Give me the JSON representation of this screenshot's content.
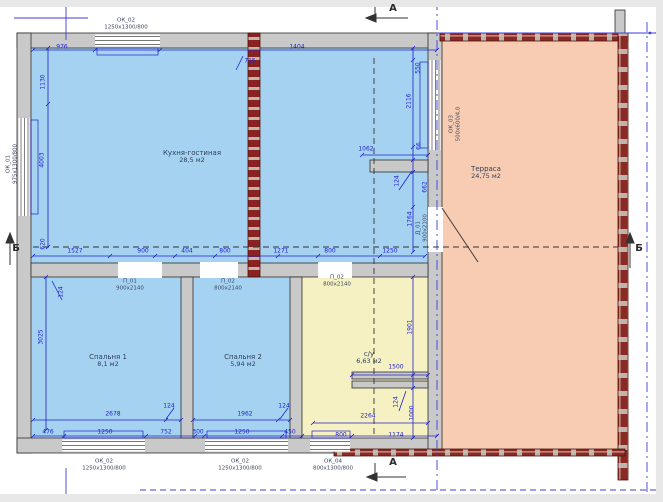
{
  "drawing": {
    "rooms": [
      {
        "name": "Кухня-гостиная",
        "area": "28,5 м2",
        "x": 192,
        "y": 157
      },
      {
        "name": "Терраса",
        "area": "24,75 м2",
        "x": 486,
        "y": 173
      },
      {
        "name": "Спальня 1",
        "area": "8,1 м2",
        "x": 108,
        "y": 361
      },
      {
        "name": "Спальня 2",
        "area": "5,94 м2",
        "x": 243,
        "y": 361
      },
      {
        "name": "с/у",
        "area": "6,63 м2",
        "x": 369,
        "y": 358
      }
    ],
    "windows": [
      {
        "tag": "ОК_02",
        "size": "1250х1300/800",
        "x": 126,
        "y": 24
      },
      {
        "tag": "ОК_01",
        "size": "975х1300/800",
        "x": 12,
        "y": 164,
        "r": -90
      },
      {
        "tag": "ОК_03",
        "size": "500х600/4,0",
        "x": 455,
        "y": 124,
        "r": -90
      },
      {
        "tag": "ОК_02",
        "size": "1250х1300/800",
        "x": 104,
        "y": 465
      },
      {
        "tag": "ОК_02",
        "size": "1250х1300/800",
        "x": 240,
        "y": 465
      },
      {
        "tag": "ОК_04",
        "size": "800х1300/800",
        "x": 333,
        "y": 465
      }
    ],
    "doors": [
      {
        "tag": "П_01",
        "size": "900х2140",
        "x": 130,
        "y": 285
      },
      {
        "tag": "П_02",
        "size": "800х2140",
        "x": 228,
        "y": 285
      },
      {
        "tag": "П_02",
        "size": "800х2140",
        "x": 337,
        "y": 281
      },
      {
        "tag": "Д_01",
        "size": "900х2100",
        "x": 422,
        "y": 228,
        "r": -90
      }
    ],
    "markers": [
      {
        "label": "А",
        "x": 393,
        "y": 9
      },
      {
        "label": "А",
        "x": 393,
        "y": 463
      },
      {
        "label": "Б",
        "x": 16,
        "y": 249
      },
      {
        "label": "Б",
        "x": 639,
        "y": 249
      }
    ],
    "dimensions": [
      {
        "t": "976",
        "x": 62,
        "y": 47
      },
      {
        "t": "1404",
        "x": 297,
        "y": 47
      },
      {
        "t": "715",
        "x": 250,
        "y": 61
      },
      {
        "t": "1130",
        "x": 43,
        "y": 82,
        "r": -90
      },
      {
        "t": "4003",
        "x": 42,
        "y": 160,
        "r": -90
      },
      {
        "t": "550",
        "x": 418,
        "y": 68,
        "r": -90
      },
      {
        "t": "2116",
        "x": 409,
        "y": 101,
        "r": -90
      },
      {
        "t": "1062",
        "x": 366,
        "y": 149
      },
      {
        "t": "66",
        "x": 419,
        "y": 146,
        "r": -90
      },
      {
        "t": "124",
        "x": 397,
        "y": 181,
        "r": -90
      },
      {
        "t": "662",
        "x": 425,
        "y": 187,
        "r": -90
      },
      {
        "t": "1764",
        "x": 410,
        "y": 219,
        "r": -90
      },
      {
        "t": "1527",
        "x": 75,
        "y": 251
      },
      {
        "t": "900",
        "x": 143,
        "y": 251
      },
      {
        "t": "404",
        "x": 187,
        "y": 251
      },
      {
        "t": "800",
        "x": 225,
        "y": 251
      },
      {
        "t": "1271",
        "x": 281,
        "y": 251
      },
      {
        "t": "800",
        "x": 330,
        "y": 251
      },
      {
        "t": "1250",
        "x": 390,
        "y": 251
      },
      {
        "t": "620",
        "x": 43,
        "y": 244,
        "r": -90
      },
      {
        "t": "124",
        "x": 61,
        "y": 292,
        "r": -90
      },
      {
        "t": "3025",
        "x": 41,
        "y": 337,
        "r": -90
      },
      {
        "t": "2678",
        "x": 113,
        "y": 414
      },
      {
        "t": "124",
        "x": 169,
        "y": 406
      },
      {
        "t": "1962",
        "x": 245,
        "y": 414
      },
      {
        "t": "124",
        "x": 284,
        "y": 406
      },
      {
        "t": "2264",
        "x": 368,
        "y": 416
      },
      {
        "t": "1901",
        "x": 410,
        "y": 327,
        "r": -90
      },
      {
        "t": "1500",
        "x": 396,
        "y": 367
      },
      {
        "t": "124",
        "x": 396,
        "y": 402,
        "r": -90
      },
      {
        "t": "1000",
        "x": 412,
        "y": 413,
        "r": -90
      },
      {
        "t": "476",
        "x": 48,
        "y": 432
      },
      {
        "t": "1250",
        "x": 105,
        "y": 432
      },
      {
        "t": "752",
        "x": 166,
        "y": 432
      },
      {
        "t": "300",
        "x": 198,
        "y": 432
      },
      {
        "t": "1250",
        "x": 242,
        "y": 432
      },
      {
        "t": "450",
        "x": 290,
        "y": 432
      },
      {
        "t": "800",
        "x": 341,
        "y": 435
      },
      {
        "t": "1174",
        "x": 396,
        "y": 435
      }
    ],
    "colors": {
      "room_blue": "#a6d2f2",
      "bathroom_yellow": "#f5f1c2",
      "terrace_salmon": "#f7ccb2",
      "wall_gray": "#c9c9c9",
      "brick_red": "#8b2a22",
      "dimension_blue": "#2020cf"
    }
  }
}
